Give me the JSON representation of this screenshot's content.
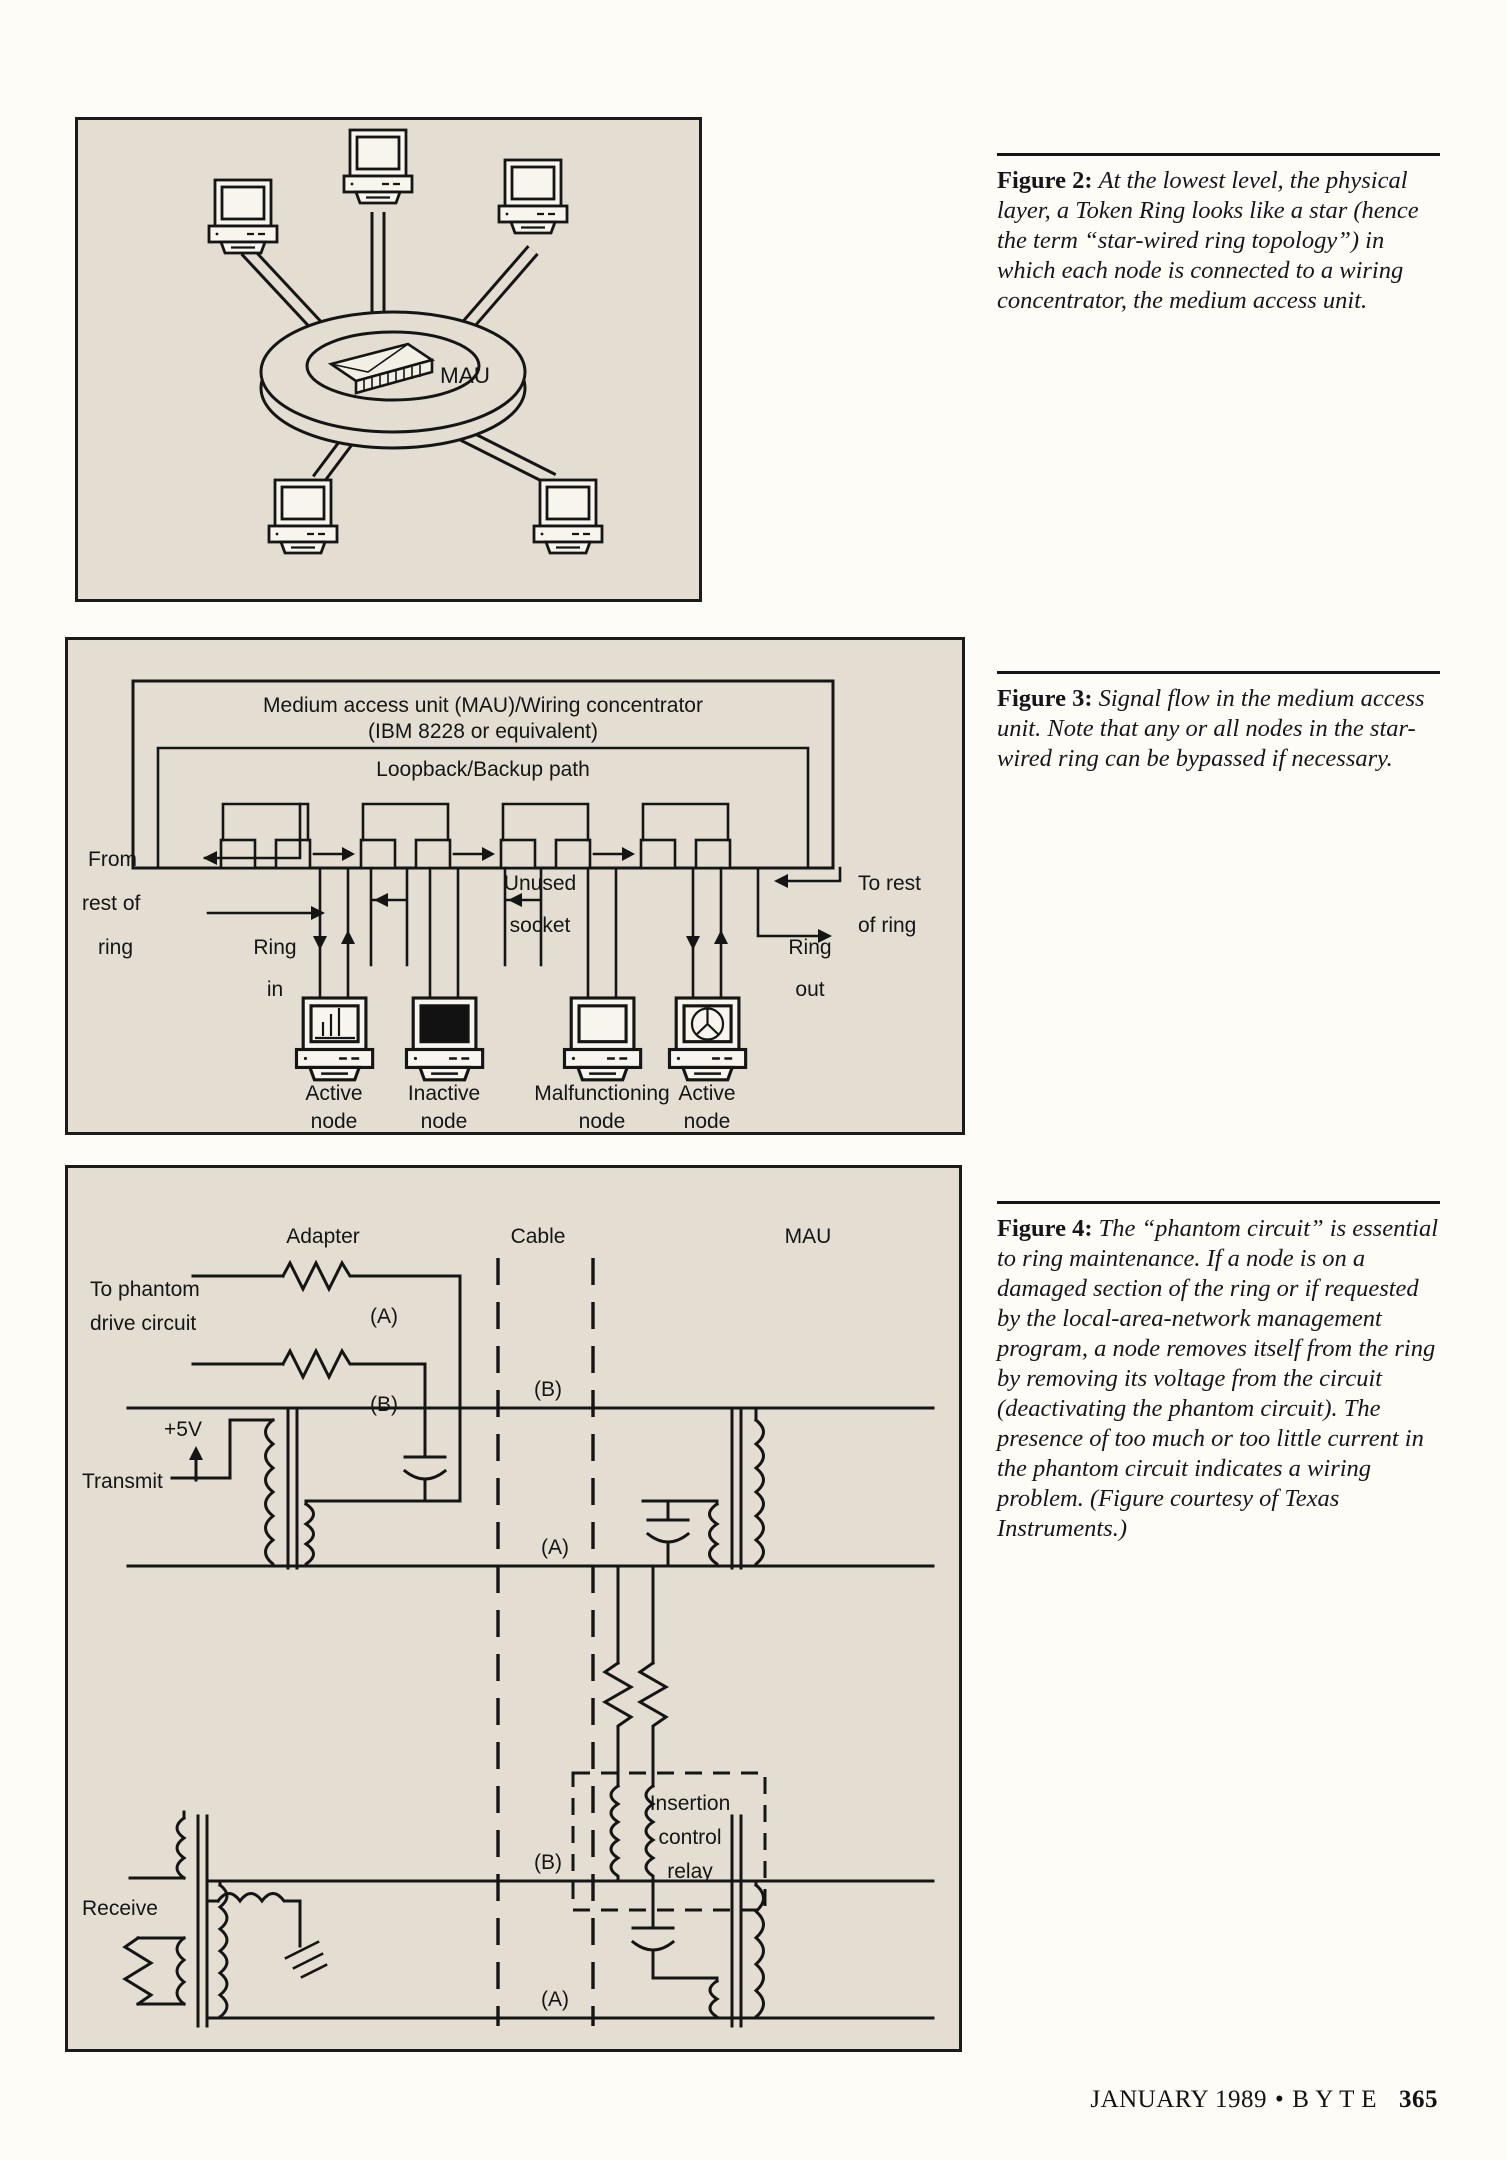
{
  "footer": {
    "issue": "JANUARY 1989",
    "bullet": "•",
    "magazine": "B Y T E",
    "page_number": "365"
  },
  "figure2": {
    "caption": {
      "lead": "Figure 2:",
      "body": "At the lowest level, the physical layer, a Token Ring looks like a star (hence the term “star-wired ring topology”) in which each node is connected to a wiring concentrator, the medium access unit."
    },
    "labels": {
      "mau": "MAU"
    }
  },
  "figure3": {
    "caption": {
      "lead": "Figure 3:",
      "body": "Signal flow in the medium access unit. Note that any or all nodes in the star-wired ring can be bypassed if necessary."
    },
    "labels": {
      "title_line1": "Medium access unit (MAU)/Wiring concentrator",
      "title_line2": "(IBM 8228 or equivalent)",
      "loopback": "Loopback/Backup path",
      "from_line1": "From",
      "from_line2": "rest of",
      "from_line3": "ring",
      "ring_in_line1": "Ring",
      "ring_in_line2": "in",
      "unused_line1": "Unused",
      "unused_line2": "socket",
      "to_line1": "To rest",
      "to_line2": "of ring",
      "ring_out_line1": "Ring",
      "ring_out_line2": "out",
      "nodes": [
        {
          "line1": "Active",
          "line2": "node"
        },
        {
          "line1": "Inactive",
          "line2": "node"
        },
        {
          "line1": "Malfunctioning",
          "line2": "node"
        },
        {
          "line1": "Active",
          "line2": "node"
        }
      ]
    }
  },
  "figure4": {
    "caption": {
      "lead": "Figure 4:",
      "body": "The “phantom circuit” is essential to ring maintenance. If a node is on a damaged section of the ring or if requested by the local-area-network management program, a node removes itself from the ring by removing its voltage from the circuit (deactivating the phantom circuit). The presence of too much or too little current in the phantom circuit indicates a wiring problem. (Figure courtesy of Texas Instruments.)"
    },
    "labels": {
      "adapter": "Adapter",
      "cable": "Cable",
      "mau": "MAU",
      "to_phantom_line1": "To phantom",
      "to_phantom_line2": "drive circuit",
      "a": "(A)",
      "b": "(B)",
      "plus5v": "+5V",
      "transmit": "Transmit",
      "receive": "Receive",
      "relay_line1": "Insertion",
      "relay_line2": "control",
      "relay_line3": "relay"
    }
  },
  "colors": {
    "panel_bg": "#e3ded1",
    "line": "#151515",
    "page_bg": "#fdfcf7"
  }
}
